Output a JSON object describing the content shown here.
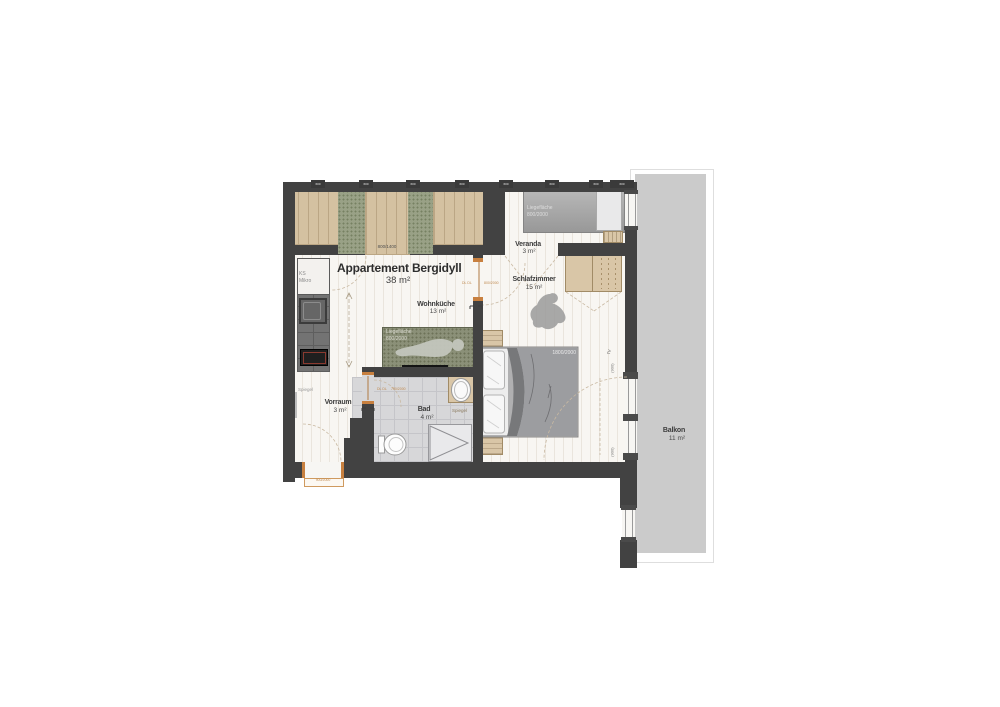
{
  "floorplan": {
    "title": "Appartement Bergidyll",
    "total_area": "38 m²",
    "rooms": {
      "wohnkueche": {
        "name": "Wohnküche",
        "area": "13 m²"
      },
      "schlafzimmer": {
        "name": "Schlafzimmer",
        "area": "15 m²"
      },
      "veranda": {
        "name": "Veranda",
        "area": "3 m²"
      },
      "vorraum": {
        "name": "Vorraum",
        "area": "3 m²"
      },
      "bad": {
        "name": "Bad",
        "area": "4 m²"
      },
      "balkon": {
        "name": "Balkon",
        "area": "11 m²"
      }
    },
    "labels": {
      "daybed_line1": "Liegefläche",
      "daybed_line2": "800/2000",
      "sofa_line1": "Liegefläche",
      "sofa_line2": "800/2000",
      "bed_size": "1800/2000",
      "deck_lounger_size": "800/1400",
      "kitchen_line1": "KS",
      "kitchen_line2": "Mikro",
      "mirror": "Spiegel",
      "tv": "TV",
      "door_hinge": "DL DL",
      "door_size_schlafzimmer": "800/2000",
      "door_size_bad": "700/2000",
      "door_size_entrance": "900/2000",
      "balcony_door_width": "(900)",
      "window_width": "600"
    },
    "colors": {
      "wall": "#424242",
      "floor": "#f8f6f2",
      "deck_wood": "#d4c1a1",
      "deck_green": "#99a186",
      "balcony": "#cbcbcb",
      "furniture_wood": "#d9c6a7",
      "door_frame": "#c8803f"
    }
  }
}
